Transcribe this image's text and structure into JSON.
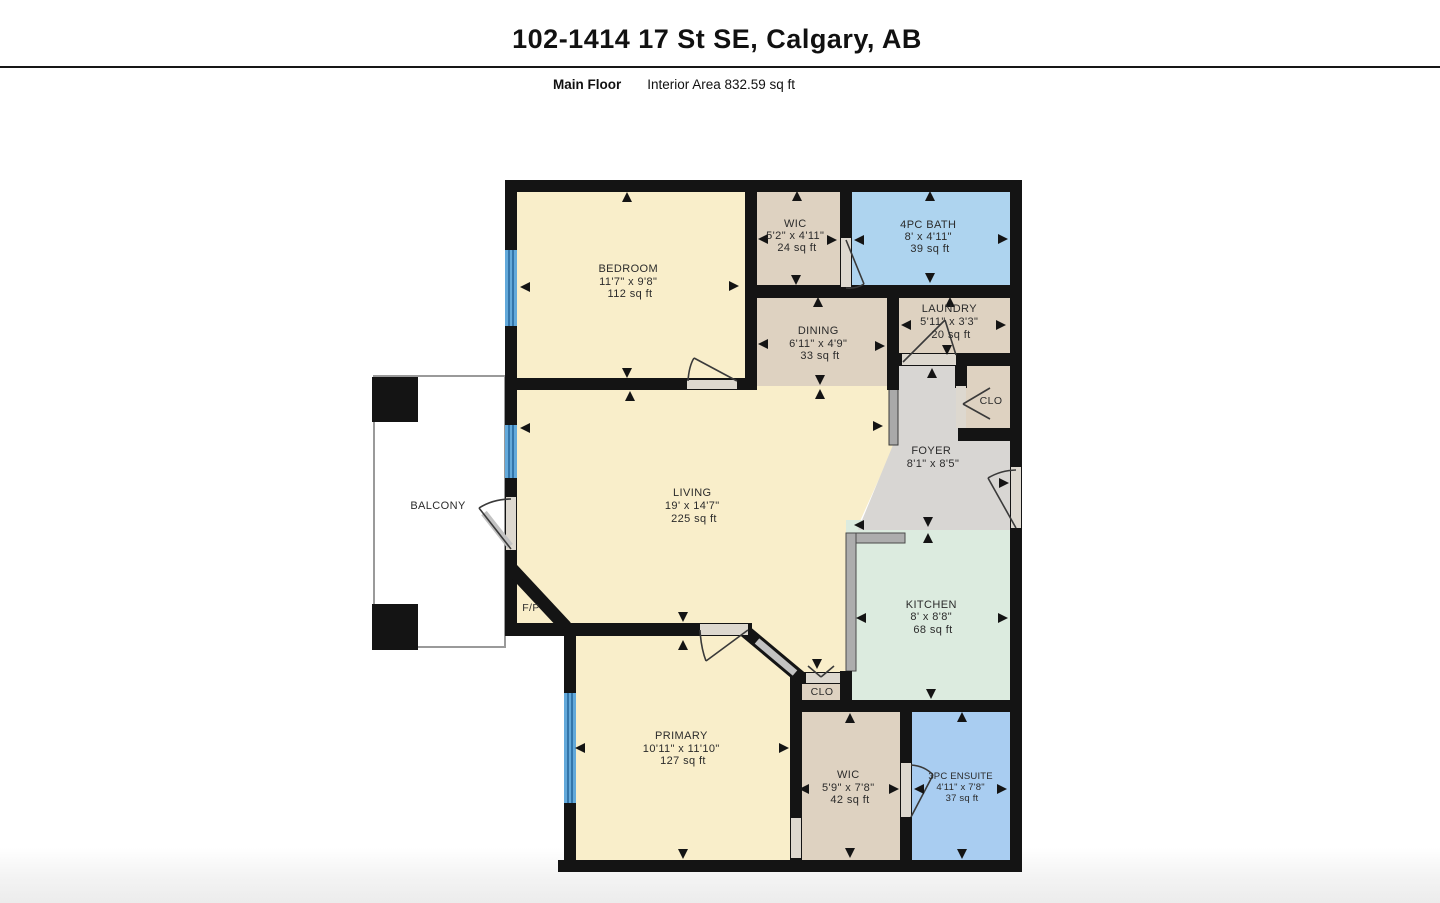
{
  "header": {
    "title": "102-1414 17 St SE, Calgary, AB",
    "floor_label": "Main Floor",
    "area_label": "Interior Area 832.59 sq ft"
  },
  "palette": {
    "wall": "#141414",
    "room_cream": "#f9eeca",
    "room_tan": "#ded2c1",
    "room_blue_bath": "#aed4ef",
    "room_blue_ensuite": "#a9cdf1",
    "room_mint": "#dcebdf",
    "room_gray_foyer": "#d8d6d3",
    "window_blue": "#63a9da",
    "counter_gray": "#adadad"
  },
  "rooms": [
    {
      "id": "bedroom",
      "name": "BEDROOM",
      "dims": "11'7\" x 9'8\"",
      "area": "112 sq ft"
    },
    {
      "id": "wic-upper",
      "name": "WIC",
      "dims": "5'2\" x 4'11\"",
      "area": "24 sq ft"
    },
    {
      "id": "bath-4pc",
      "name": "4PC BATH",
      "dims": "8' x 4'11\"",
      "area": "39 sq ft"
    },
    {
      "id": "laundry",
      "name": "LAUNDRY",
      "dims": "5'11\" x 3'3\"",
      "area": "20 sq ft"
    },
    {
      "id": "dining",
      "name": "DINING",
      "dims": "6'11\" x 4'9\"",
      "area": "33 sq ft"
    },
    {
      "id": "closet-upper",
      "name": "CLO"
    },
    {
      "id": "foyer",
      "name": "FOYER",
      "dims": "8'1\" x 8'5\""
    },
    {
      "id": "living",
      "name": "LIVING",
      "dims": "19' x 14'7\"",
      "area": "225 sq ft"
    },
    {
      "id": "kitchen",
      "name": "KITCHEN",
      "dims": "8' x 8'8\"",
      "area": "68 sq ft"
    },
    {
      "id": "fireplace",
      "name": "F/P"
    },
    {
      "id": "balcony",
      "name": "BALCONY"
    },
    {
      "id": "closet-lower",
      "name": "CLO"
    },
    {
      "id": "primary",
      "name": "PRIMARY",
      "dims": "10'11\" x 11'10\"",
      "area": "127 sq ft"
    },
    {
      "id": "wic-lower",
      "name": "WIC",
      "dims": "5'9\" x 7'8\"",
      "area": "42 sq ft"
    },
    {
      "id": "ensuite-3pc",
      "name": "3PC ENSUITE",
      "dims": "4'11\" x 7'8\"",
      "area": "37 sq ft"
    }
  ],
  "plan": {
    "arrows": [
      {
        "x": 627,
        "y": 198,
        "d": "up"
      },
      {
        "x": 526,
        "y": 287,
        "d": "left"
      },
      {
        "x": 733,
        "y": 286,
        "d": "right"
      },
      {
        "x": 627,
        "y": 372,
        "d": "down"
      },
      {
        "x": 630,
        "y": 397,
        "d": "up"
      },
      {
        "x": 797,
        "y": 197,
        "d": "up"
      },
      {
        "x": 764,
        "y": 239,
        "d": "left"
      },
      {
        "x": 831,
        "y": 240,
        "d": "right"
      },
      {
        "x": 796,
        "y": 279,
        "d": "down"
      },
      {
        "x": 930,
        "y": 197,
        "d": "up"
      },
      {
        "x": 860,
        "y": 240,
        "d": "left"
      },
      {
        "x": 1002,
        "y": 239,
        "d": "right"
      },
      {
        "x": 930,
        "y": 277,
        "d": "down"
      },
      {
        "x": 950,
        "y": 303,
        "d": "up"
      },
      {
        "x": 907,
        "y": 325,
        "d": "left"
      },
      {
        "x": 1000,
        "y": 325,
        "d": "right"
      },
      {
        "x": 947,
        "y": 349,
        "d": "down"
      },
      {
        "x": 818,
        "y": 303,
        "d": "up"
      },
      {
        "x": 764,
        "y": 344,
        "d": "left"
      },
      {
        "x": 879,
        "y": 346,
        "d": "right"
      },
      {
        "x": 820,
        "y": 379,
        "d": "down"
      },
      {
        "x": 820,
        "y": 395,
        "d": "up"
      },
      {
        "x": 932,
        "y": 374,
        "d": "up"
      },
      {
        "x": 1003,
        "y": 483,
        "d": "right"
      },
      {
        "x": 928,
        "y": 521,
        "d": "down"
      },
      {
        "x": 928,
        "y": 539,
        "d": "up"
      },
      {
        "x": 526,
        "y": 428,
        "d": "left"
      },
      {
        "x": 877,
        "y": 426,
        "d": "right"
      },
      {
        "x": 683,
        "y": 616,
        "d": "down"
      },
      {
        "x": 860,
        "y": 525,
        "d": "left"
      },
      {
        "x": 862,
        "y": 618,
        "d": "left"
      },
      {
        "x": 1002,
        "y": 618,
        "d": "right"
      },
      {
        "x": 931,
        "y": 693,
        "d": "down"
      },
      {
        "x": 817,
        "y": 663,
        "d": "down"
      },
      {
        "x": 683,
        "y": 646,
        "d": "up"
      },
      {
        "x": 581,
        "y": 748,
        "d": "left"
      },
      {
        "x": 783,
        "y": 748,
        "d": "right"
      },
      {
        "x": 683,
        "y": 853,
        "d": "down"
      },
      {
        "x": 850,
        "y": 719,
        "d": "up"
      },
      {
        "x": 805,
        "y": 789,
        "d": "left"
      },
      {
        "x": 893,
        "y": 789,
        "d": "right"
      },
      {
        "x": 850,
        "y": 852,
        "d": "down"
      },
      {
        "x": 962,
        "y": 718,
        "d": "up"
      },
      {
        "x": 920,
        "y": 789,
        "d": "left"
      },
      {
        "x": 1001,
        "y": 789,
        "d": "right"
      },
      {
        "x": 962,
        "y": 853,
        "d": "down"
      }
    ]
  }
}
